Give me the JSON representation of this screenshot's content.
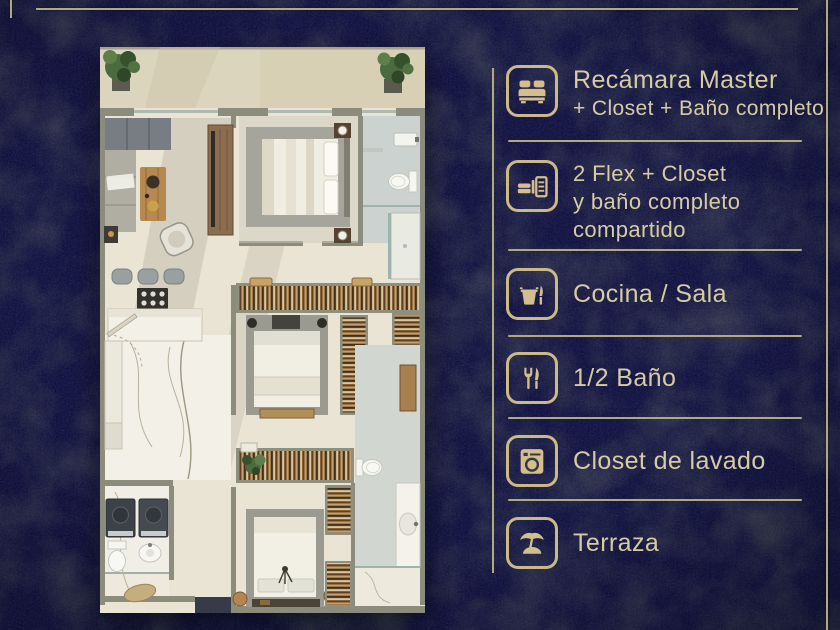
{
  "accent": {
    "background": "#363a49",
    "gold_line": "#b3a87e",
    "icon_gold": "#d4bf8c",
    "text_gold": "#d7cba4"
  },
  "legend": {
    "items": [
      {
        "icon": "bed-icon",
        "lines": [
          "Recámara Master",
          "+ Closet + Baño completo"
        ]
      },
      {
        "icon": "bed-closet-icon",
        "lines": [
          "2 Flex + Closet",
          "y baño completo",
          "compartido"
        ]
      },
      {
        "icon": "kitchen-pot-icon",
        "lines": [
          "Cocina / Sala"
        ]
      },
      {
        "icon": "cutlery-icon",
        "lines": [
          "1/2 Baño"
        ]
      },
      {
        "icon": "washing-machine-icon",
        "lines": [
          "Closet de lavado"
        ]
      },
      {
        "icon": "palm-terrace-icon",
        "lines": [
          "Terraza"
        ]
      }
    ]
  },
  "floor_plan": {
    "description": "Top-down architectural render of an apartment: terrace with plants, living room and kitchen, master bedroom with bathroom, two flex bedrooms with closets, shared bathroom, half bath and laundry closet"
  }
}
